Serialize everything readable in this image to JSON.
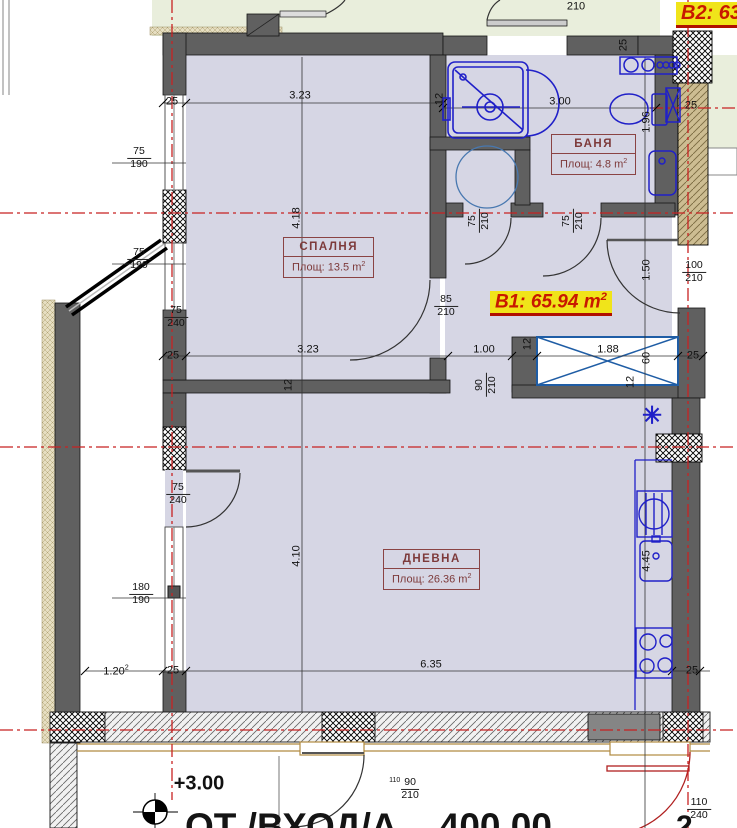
{
  "plan": {
    "b1_label": {
      "text": "B1: 65.94 m",
      "sup": "2"
    },
    "b2_label": {
      "text": "B2: 63.0"
    },
    "rooms": {
      "bedroom": {
        "name": "СПАЛНЯ",
        "area": "Площ: 13.5 m",
        "area_sup": "2"
      },
      "bath": {
        "name": "БАНЯ",
        "area": "Площ: 4.8 m",
        "area_sup": "2"
      },
      "living": {
        "name": "ДНЕВНА",
        "area": "Площ: 26.36 m",
        "area_sup": "2"
      }
    },
    "level_label": "+3.00",
    "star_symbol": "✳",
    "bottom_text": "ОТ /ВХОД/А    400.00",
    "bottom_text_sup": "2"
  },
  "dimensions": {
    "d_323_top": "3.23",
    "d_25_top_left": "25",
    "d_12_shower": "12",
    "d_300": "3.00",
    "d_25_ne": "25",
    "d_25_right": "25",
    "d_196": "1.96",
    "d_418": "4.18",
    "d_150": "1.50",
    "d_323_mid": "3.23",
    "d_25_mid_left": "25",
    "d_100": "1.00",
    "d_188": "1.88",
    "d_60": "60",
    "d_25_mid_right": "25",
    "d_12_part": "12",
    "d_12_shaft": "12",
    "d_12_shaft2": "12",
    "d_410": "4.10",
    "d_445": "4.45",
    "d_120": "1.20",
    "d_120_sup": "2",
    "d_25_bot_left": "25",
    "d_635": "6.35",
    "d_25_bot_right": "25",
    "d_210_top": "210"
  },
  "openings": {
    "w1": {
      "num": "75",
      "den": "190"
    },
    "w2": {
      "num": "75",
      "den": "190"
    },
    "d1": {
      "num": "75",
      "den": "240"
    },
    "bed_door": {
      "num": "85",
      "den": "210"
    },
    "balc_door": {
      "num": "100",
      "den": "210"
    },
    "d2": {
      "num": "75",
      "den": "240"
    },
    "w3": {
      "num": "180",
      "den": "190"
    },
    "pass_door": {
      "num": "90",
      "den": "210"
    },
    "wc_door": {
      "num": "75",
      "den": "210"
    },
    "bath_door": {
      "num": "75",
      "den": "210"
    },
    "terrace_door": {
      "prefix": "110",
      "num": "90",
      "den": "210"
    },
    "terrace_door2": {
      "num": "110",
      "den": "240"
    }
  }
}
